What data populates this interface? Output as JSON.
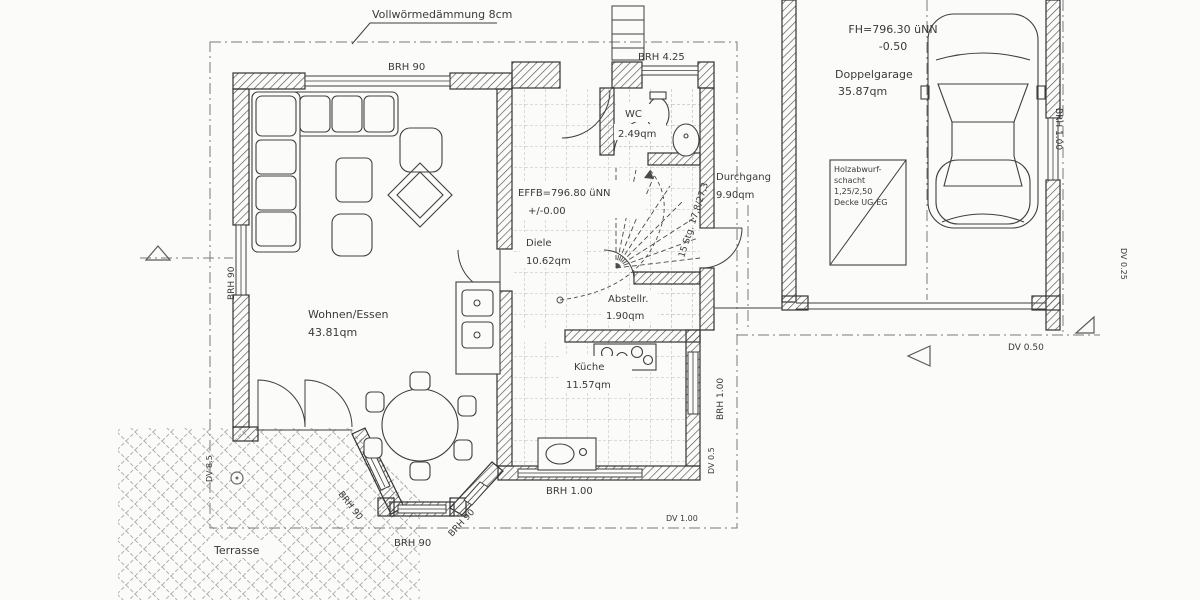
{
  "annotations": {
    "insulation": "Vollwörmedämmung 8cm",
    "stairs": "15 Stg. 17,8/27,3",
    "levels": {
      "effb_1": "EFFB=796.80 üNN",
      "effb_2": "+/-0.00",
      "fh_1": "FH=796.30 üNN",
      "fh_2": "-0.50"
    },
    "chute": {
      "line1": "Holzabwurf-",
      "line2": "schacht",
      "line3": "1,25/2,50",
      "line4": "Decke UG-EG"
    }
  },
  "rooms": {
    "wohnen": {
      "name": "Wohnen/Essen",
      "area": "43.81qm"
    },
    "diele": {
      "name": "Diele",
      "area": "10.62qm"
    },
    "wc": {
      "name": "WC",
      "area": "2.49qm"
    },
    "abstell": {
      "name": "Abstellr.",
      "area": "1.90qm"
    },
    "kueche": {
      "name": "Küche",
      "area": "11.57qm"
    },
    "durchgang": {
      "name": "Durchgang",
      "area": "9.90qm"
    },
    "garage": {
      "name": "Doppelgarage",
      "area": "35.87qm"
    },
    "terrasse": {
      "name": "Terrasse"
    }
  },
  "dimensions": {
    "brh_90": "BRH 90",
    "brh_425": "BRH 4.25",
    "brh_100": "BRH 1.00",
    "dv_05": "DV 0.5",
    "dv_85": "DV 8.5",
    "dv_100": "DV 1.00",
    "dv_050": "DV 0.50",
    "dv_025": "DV 0.25"
  },
  "colors": {
    "ink": "#3a3a3a",
    "hatch": "#4e4e4e",
    "tile": "#a5a5a5",
    "lattice": "#b0b0b0"
  }
}
